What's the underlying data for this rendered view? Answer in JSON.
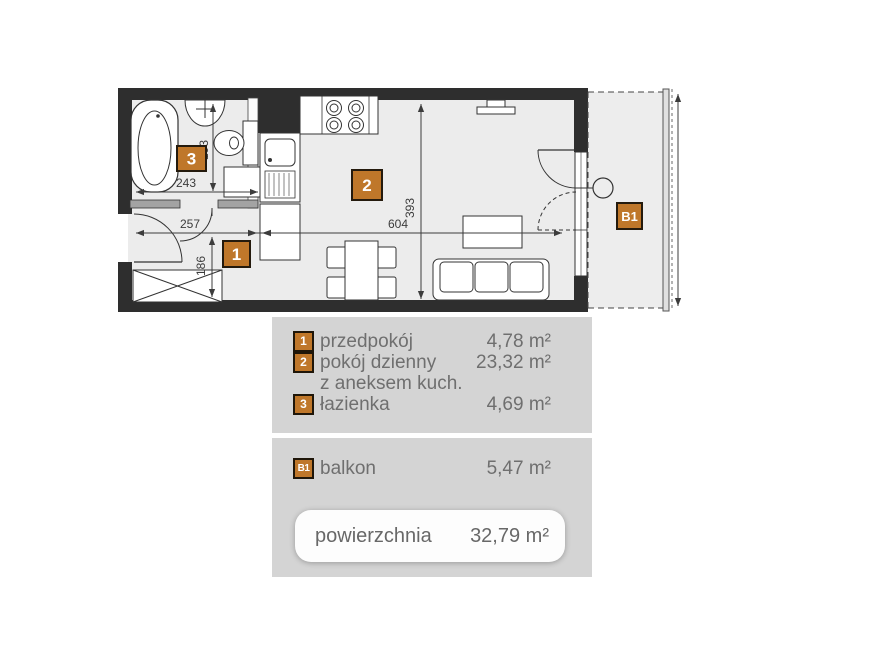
{
  "colors": {
    "accent": "#bf772a",
    "wall": "#2e2e2e",
    "panel_bg": "#d4d4d4",
    "legend_text": "#6f6f6f",
    "dim_text": "#3c3c3c"
  },
  "plan": {
    "labels": {
      "hall": "1",
      "living": "2",
      "bath": "3",
      "balcony": "B1"
    },
    "dims": {
      "bath_width": "243",
      "bath_height": "193",
      "hall_width": "257",
      "hall_height": "186",
      "living_width": "604",
      "living_height": "393"
    }
  },
  "legend": {
    "rooms": [
      {
        "num": "1",
        "label": "przedpokój",
        "area": "4,78 m²"
      },
      {
        "num": "2",
        "label": "pokój dzienny",
        "area": "23,32 m²"
      },
      {
        "num": "",
        "label": "z aneksem kuch.",
        "area": ""
      },
      {
        "num": "3",
        "label": "łazienka",
        "area": "4,69 m²"
      }
    ],
    "balcony": {
      "num": "B1",
      "label": "balkon",
      "area": "5,47 m²"
    },
    "total": {
      "label": "powierzchnia",
      "value": "32,79 m²"
    }
  }
}
